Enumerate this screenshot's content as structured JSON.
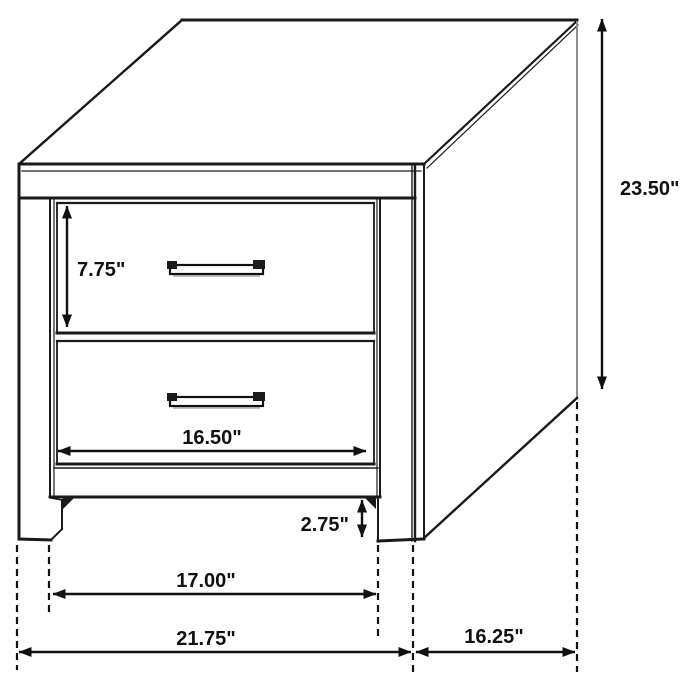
{
  "diagram": {
    "subject": "nightstand-two-drawer-dimension-drawing",
    "units": "inches",
    "background_color": "#ffffff",
    "line_color": "#1a1a1a",
    "dimensions": {
      "total_height": "23.50\"",
      "drawer_front_height": "7.75\"",
      "drawer_width": "16.50\"",
      "leg_clearance": "2.75\"",
      "inner_width": "17.00\"",
      "overall_width": "21.75\"",
      "depth": "16.25\""
    }
  }
}
